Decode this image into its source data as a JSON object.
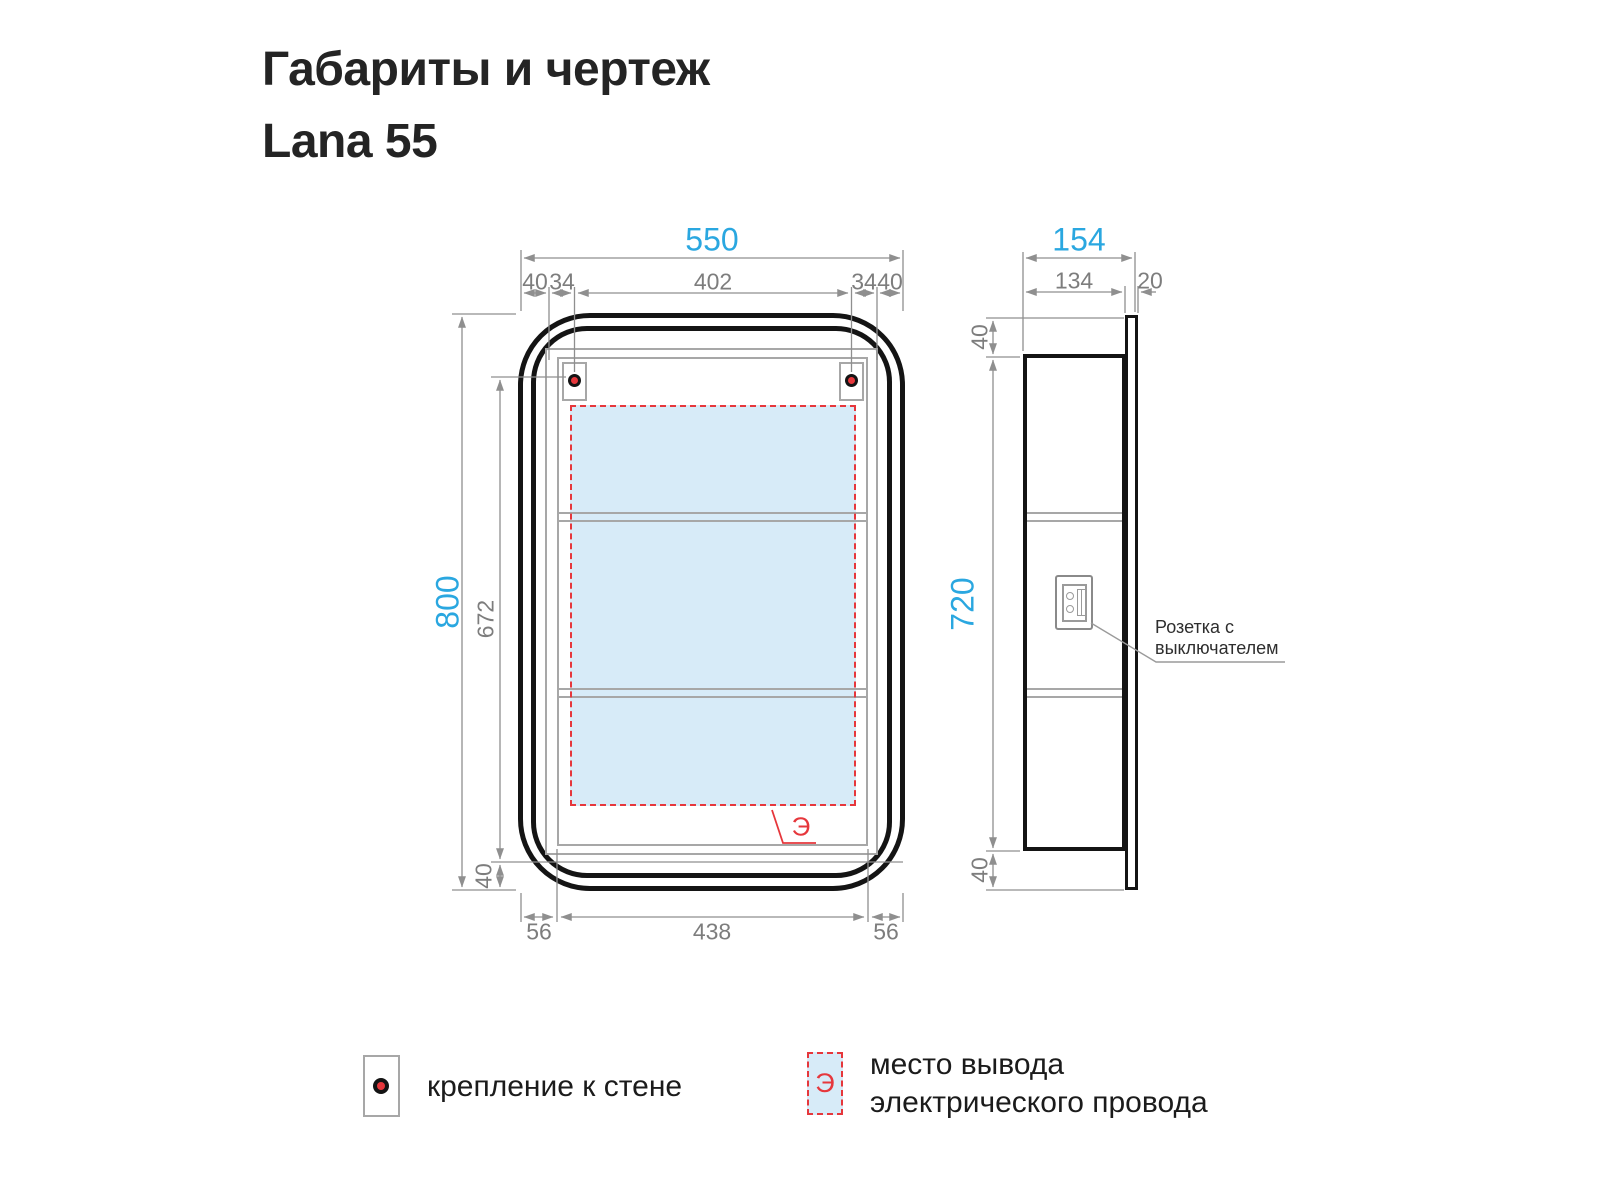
{
  "title": {
    "line1": "Габариты и чертеж",
    "line2": "Lana 55"
  },
  "front_view": {
    "dims": {
      "total_width": "550",
      "left_margin": "40",
      "left_offset": "34",
      "mount_span": "402",
      "right_offset": "34",
      "right_margin": "40",
      "total_height": "800",
      "mount_height": "672",
      "bottom_margin": "40",
      "bottom_left": "56",
      "bottom_inner": "438",
      "bottom_right": "56"
    },
    "electrical_zone_symbol": "Э"
  },
  "side_view": {
    "dims": {
      "total_depth": "154",
      "body_depth": "134",
      "door_depth": "20",
      "top_margin": "40",
      "body_height": "720",
      "bottom_margin": "40"
    },
    "socket_label": {
      "line1": "Розетка с",
      "line2": "выключателем"
    }
  },
  "legend": {
    "wall_mount": {
      "label": "крепление к стене"
    },
    "electrical_outlet": {
      "symbol": "Э",
      "line1": "место вывода",
      "line2": "электрического провода"
    }
  },
  "colors": {
    "dimension_accent": "#2aa7e0",
    "electrical_red": "#e6373c",
    "zone_fill": "#d7ebf8",
    "drawing_line": "#141414",
    "hairline_gray": "#8f8f8f"
  }
}
